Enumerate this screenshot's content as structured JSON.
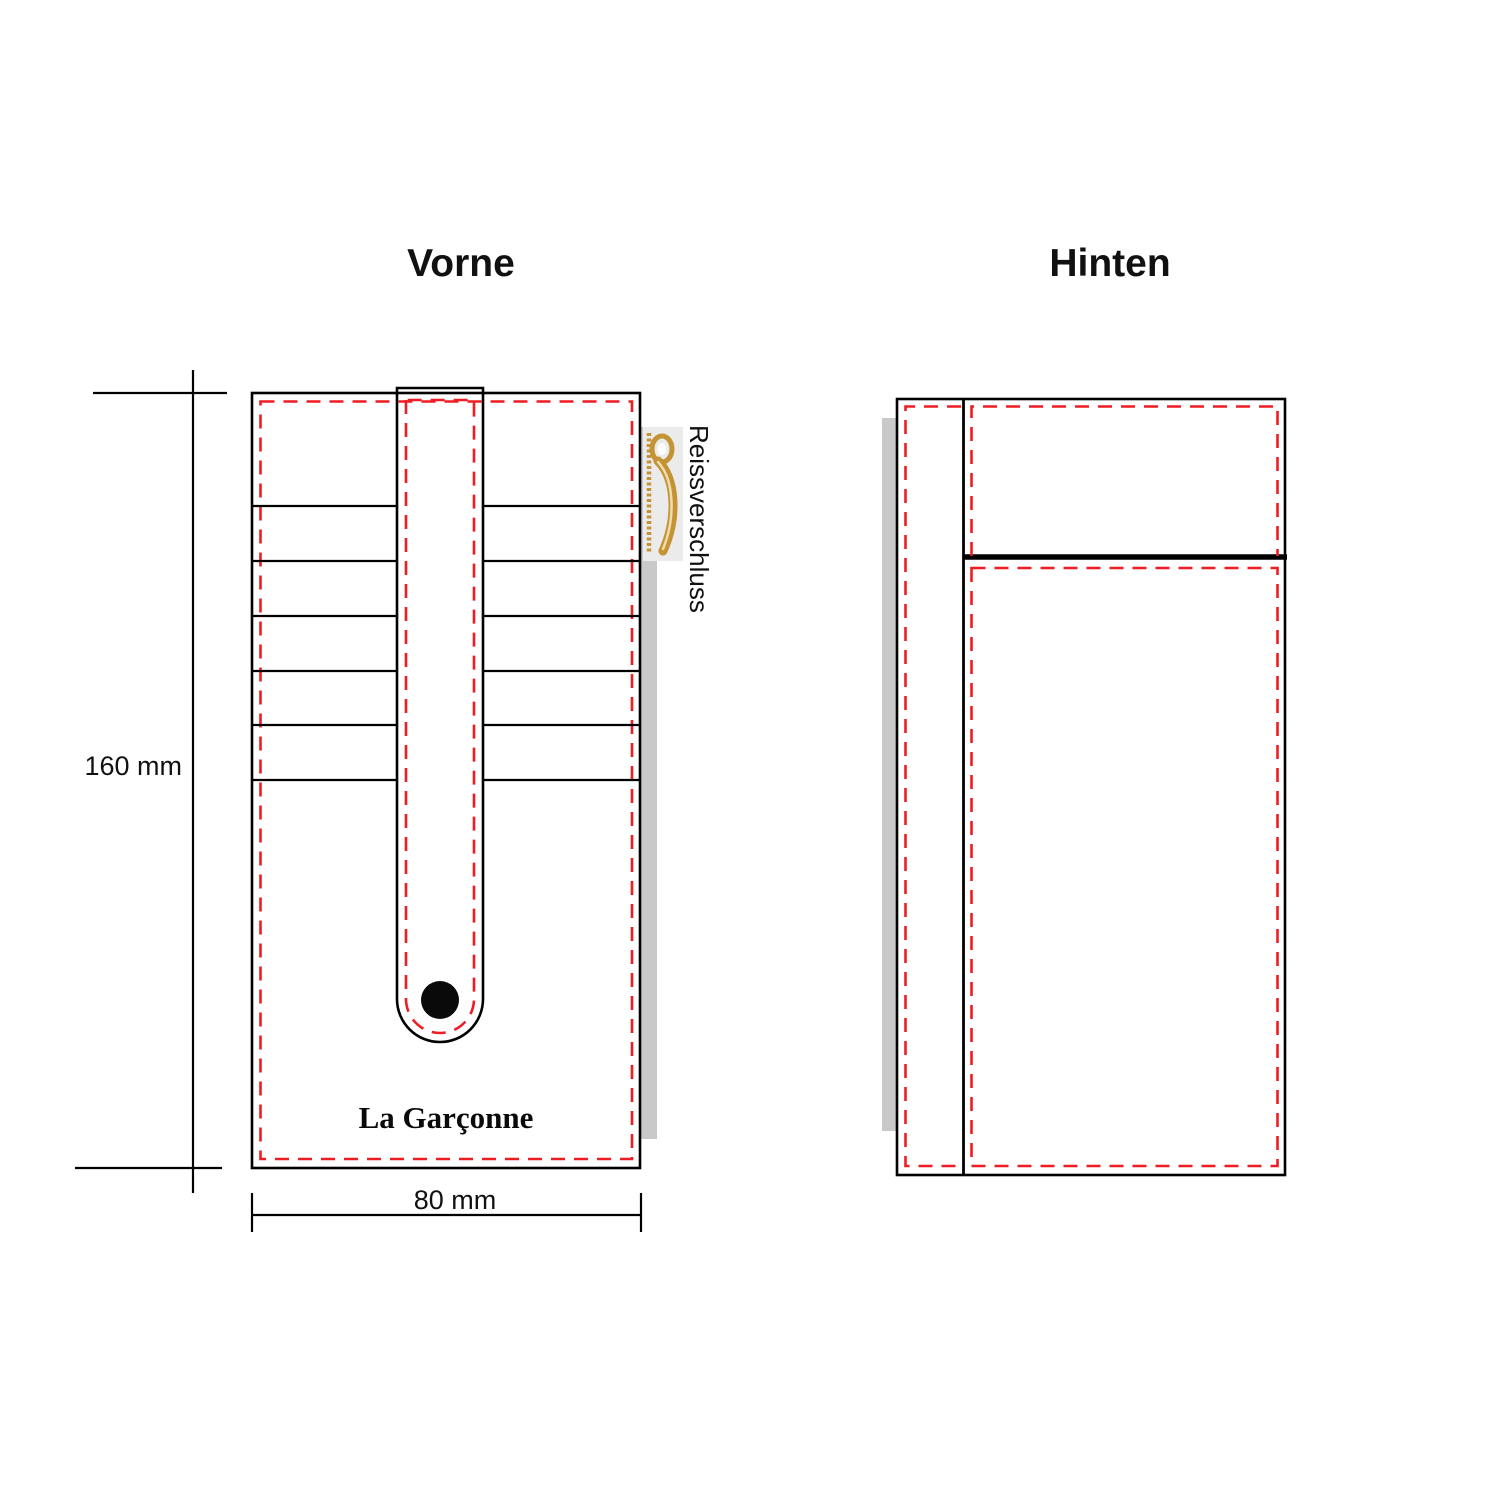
{
  "front": {
    "title": "Vorne",
    "brand": "La Garçonne",
    "zipper_label": "Reissverschluss",
    "card_slot_lines_y": [
      506,
      561,
      616,
      671,
      725,
      780
    ],
    "card_slot_count_per_side": 6
  },
  "back": {
    "title": "Hinten"
  },
  "dimensions": {
    "height_label": "160 mm",
    "width_label": "80 mm"
  },
  "colors": {
    "stitch_red": "#ee1c23",
    "outline_black": "#000000",
    "shadow_gray": "#c9c9c9",
    "zipper_backdrop": "#ebebeb",
    "zipper_gold": "#c39334",
    "zipper_gold_light": "#f0ddae"
  }
}
